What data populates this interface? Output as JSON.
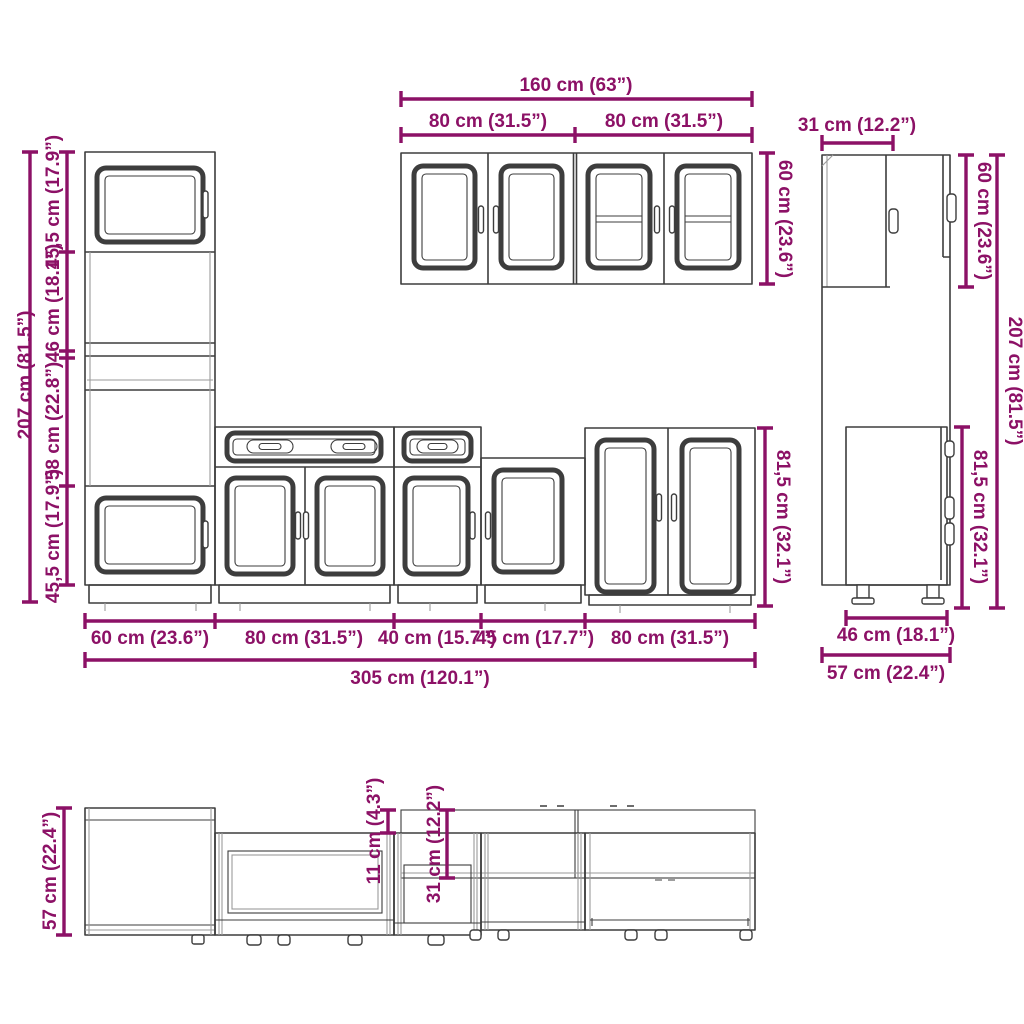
{
  "accent_color": "#8C1166",
  "line_color": "#3d3d3d",
  "light_line_color": "#9a9a9a",
  "front_view": {
    "total_height": "207 cm (81.5”)",
    "height_segments": [
      "45,5 cm (17.9”)",
      "46 cm (18.1”)",
      "58 cm (22.8”)",
      "45,5 cm (17.9”)"
    ],
    "wall_total_width": "160 cm (63”)",
    "wall_left_width": "80 cm (31.5”)",
    "wall_right_width": "80 cm (31.5”)",
    "wall_height": "60 cm (23.6”)",
    "base_height": "81,5 cm (32.1”)",
    "bottom_segments": [
      "60 cm (23.6”)",
      "80 cm (31.5”)",
      "40 cm (15.7”)",
      "45 cm (17.7”)",
      "80 cm (31.5”)"
    ],
    "bottom_total": "305 cm (120.1”)"
  },
  "side_view": {
    "top_depth": "31 cm (12.2”)",
    "wall_height": "60 cm (23.6”)",
    "base_height": "81,5 cm (32.1”)",
    "total_height": "207 cm (81.5”)",
    "base_depth": "46 cm (18.1”)",
    "total_depth": "57 cm (22.4”)"
  },
  "top_view": {
    "depth": "57 cm (22.4”)",
    "depth_offset": "11 cm (4.3”)",
    "wall_depth": "31 cm (12.2”)"
  }
}
